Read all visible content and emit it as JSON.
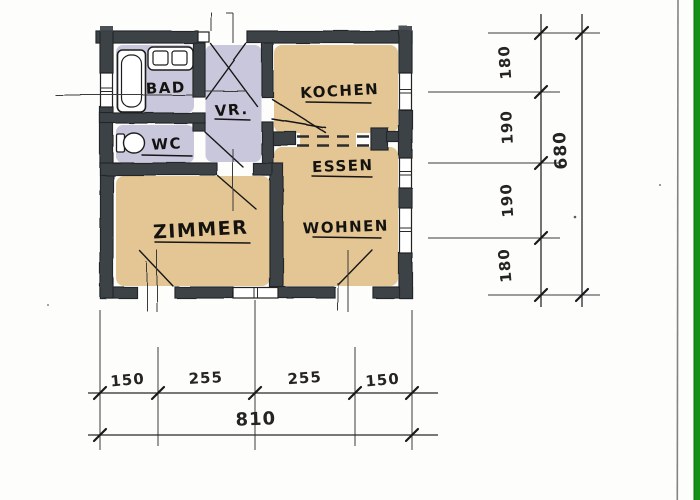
{
  "plan": {
    "rooms": [
      {
        "name": "bad",
        "label": "BAD"
      },
      {
        "name": "wc",
        "label": "WC"
      },
      {
        "name": "vorraum",
        "label": "VR."
      },
      {
        "name": "kochen",
        "label": "KOCHEN"
      },
      {
        "name": "essen",
        "label": "ESSEN"
      },
      {
        "name": "wohnen",
        "label": "WOHNEN"
      },
      {
        "name": "zimmer",
        "label": "ZIMMER"
      }
    ]
  },
  "dimensions": {
    "vertical": {
      "segments": [
        "180",
        "190",
        "190",
        "180"
      ],
      "total": "680"
    },
    "horizontal": {
      "segments": [
        "150",
        "255",
        "255",
        "150"
      ],
      "total": "810"
    }
  },
  "colors": {
    "wall": "#3d4246",
    "floor_tan": "#e3c693",
    "floor_lavender": "#c9c7dc",
    "scan_stripe_green": "#17901a",
    "scan_line_gray": "#6e6e6e",
    "ink": "#1a1a1a",
    "paper": "#fdfdfc"
  }
}
